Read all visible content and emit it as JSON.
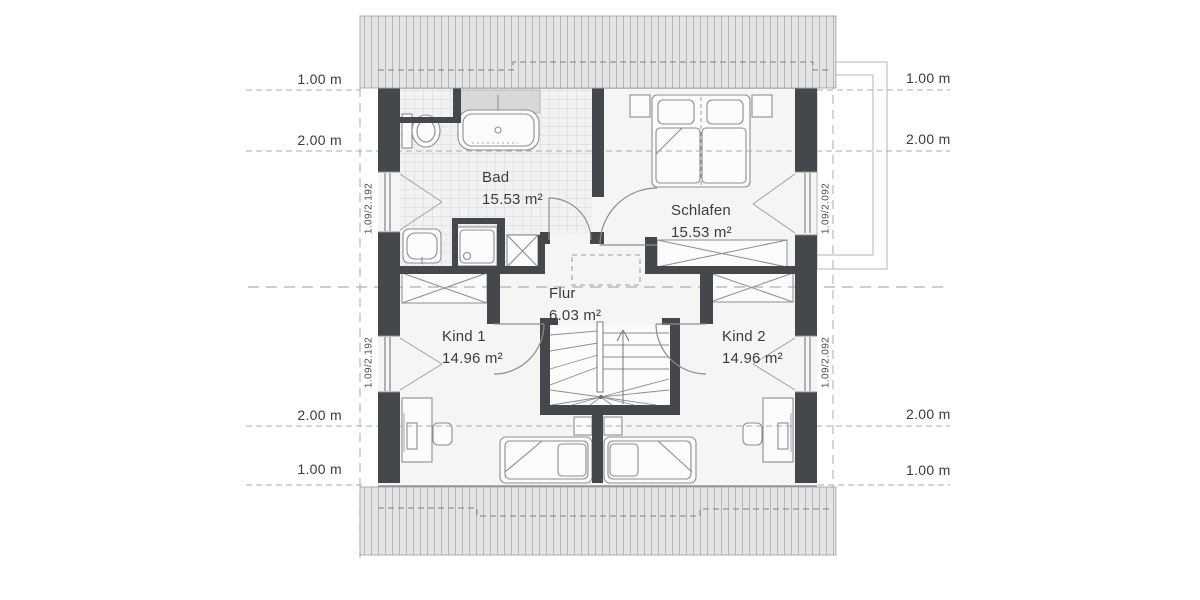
{
  "plan": {
    "rooms": [
      {
        "name": "Bad",
        "area": "15.53 m²"
      },
      {
        "name": "Schlafen",
        "area": "15.53 m²"
      },
      {
        "name": "Flur",
        "area": "6.03 m²"
      },
      {
        "name": "Kind 1",
        "area": "14.96 m²"
      },
      {
        "name": "Kind 2",
        "area": "14.96 m²"
      }
    ],
    "dimension_labels": {
      "left_top_1": "1.00 m",
      "left_top_2": "2.00 m",
      "left_bottom_2": "2.00 m",
      "left_bottom_1": "1.00 m",
      "right_top_1": "1.00 m",
      "right_top_2": "2.00 m",
      "right_bottom_2": "2.00 m",
      "right_bottom_1": "1.00 m"
    },
    "window_labels": {
      "left": "1.09/2.192",
      "right": "1.09/2.092"
    },
    "colors": {
      "wall": "#44484d",
      "roof_hatch_bg": "#e3e4e5",
      "roof_hatch_line": "#b4b6b8",
      "furniture_line": "#8b8e91",
      "dashed_line": "#a8abad",
      "tile_line": "#ccced0",
      "alcove_fill": "#d6d8da",
      "text": "#393c40"
    }
  }
}
